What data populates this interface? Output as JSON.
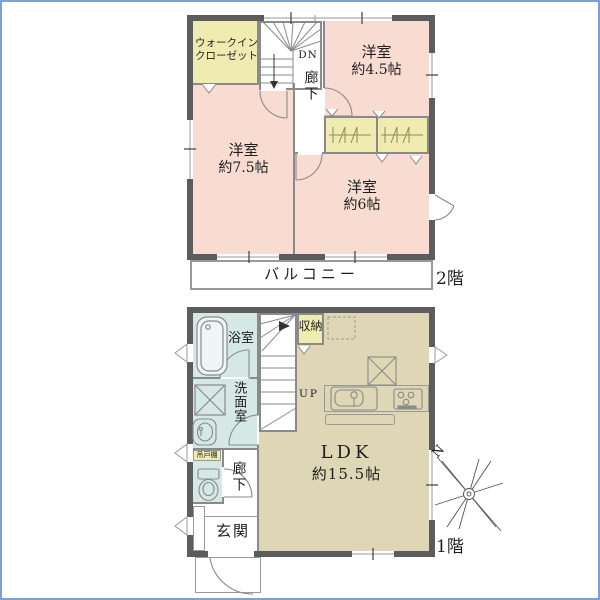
{
  "colors": {
    "room_pink": "#f8dcd2",
    "closet_yellow": "#f0ebb0",
    "wet_area_blue": "#d6e8e4",
    "ldk_beige": "#ded6b5",
    "wall_dark": "#5c5c5c",
    "line_gray": "#8a8a8a",
    "frame_blue": "#7da0d8"
  },
  "floor2": {
    "label": "2階",
    "walk_in_closet": [
      "ウォークイン",
      "クローゼット"
    ],
    "down": "DN",
    "corridor": "廊下",
    "room_45": [
      "洋室",
      "約4.5帖"
    ],
    "room_75": [
      "洋室",
      "約7.5帖"
    ],
    "room_6": [
      "洋室",
      "約6帖"
    ],
    "balcony": "バルコニー"
  },
  "floor1": {
    "label": "1階",
    "bathroom": "浴室",
    "washroom": "洗面室",
    "hanging_cupboard": "吊戸棚",
    "corridor": "廊下",
    "entrance": "玄関",
    "storage": "収納",
    "up": "UP",
    "ldk": [
      "LDK",
      "約15.5帖"
    ],
    "north": "N"
  }
}
